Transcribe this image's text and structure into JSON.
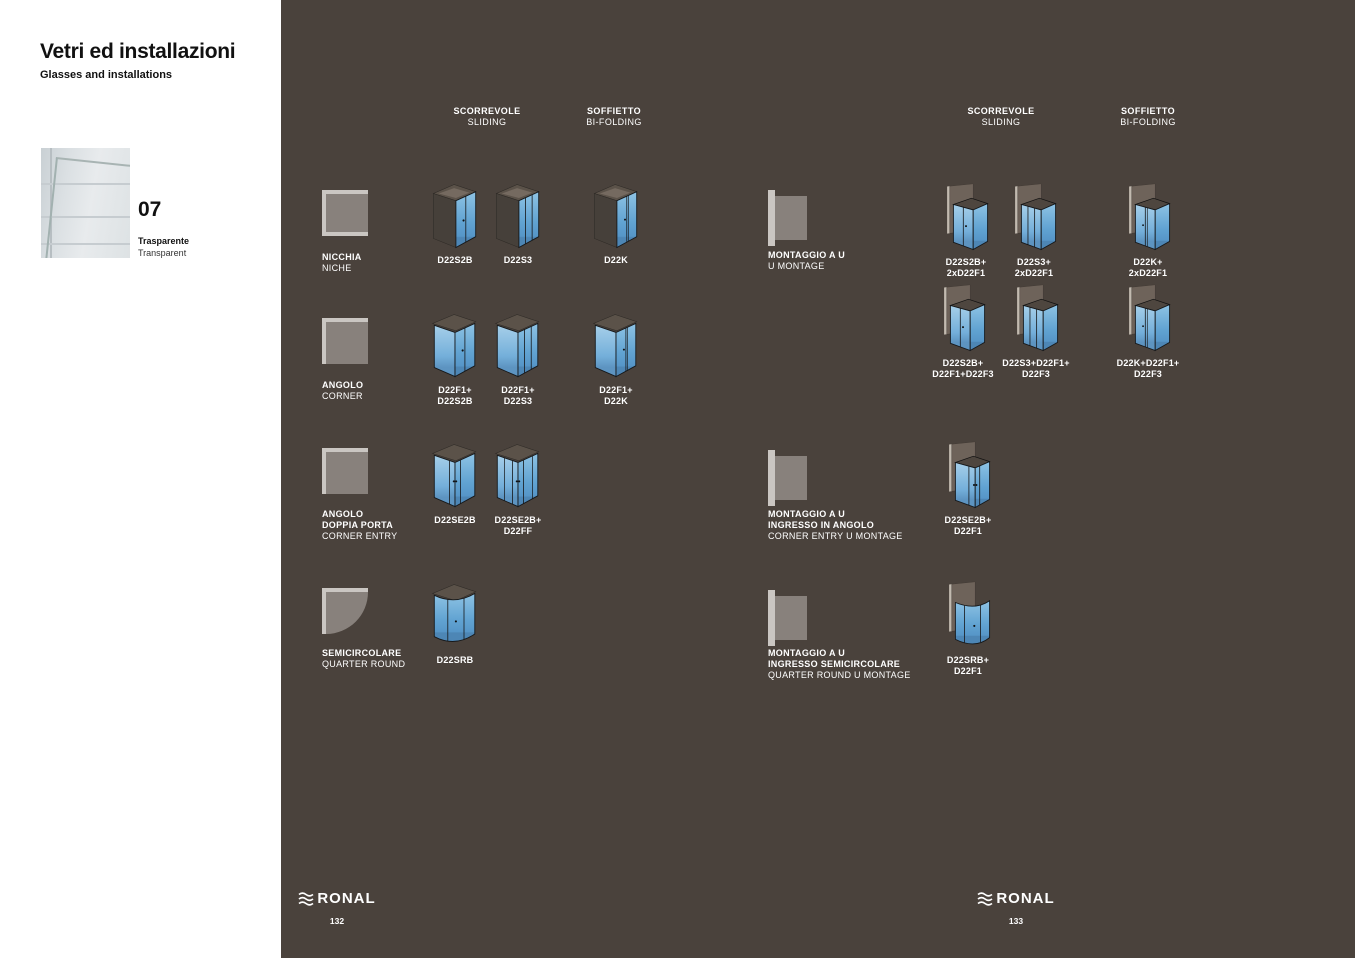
{
  "sidebar": {
    "title": "Vetri ed installazioni",
    "subtitle": "Glasses and installations",
    "swatch": {
      "number": "07",
      "name_primary": "Trasparente",
      "name_secondary": "Transparent",
      "image": "transparent-glass-photo"
    }
  },
  "colors": {
    "panel_bg": "#4a423c",
    "glass_blue": "#5f9fd2",
    "plan_icon_frame": "#cac6c2",
    "plan_icon_fill": "#88817c",
    "text": "#ffffff"
  },
  "groups": {
    "left": {
      "headers": [
        {
          "it": "SCORREVOLE",
          "en": "SLIDING"
        },
        {
          "it": "SOFFIETTO",
          "en": "BI-FOLDING"
        }
      ],
      "rows": [
        {
          "icon": "niche-plan-icon",
          "it1": "NICCHIA",
          "en": "NICHE",
          "products": [
            {
              "icon": "shower-sliding2-icon",
              "l1": "D22S2B"
            },
            {
              "icon": "shower-sliding3-icon",
              "l1": "D22S3"
            },
            {
              "icon": "shower-bifold-icon",
              "l1": "D22K"
            }
          ]
        },
        {
          "icon": "corner-plan-icon",
          "it1": "ANGOLO",
          "en": "CORNER",
          "products": [
            {
              "icon": "shower-corner-sliding2-icon",
              "l1": "D22F1+",
              "l2": "D22S2B"
            },
            {
              "icon": "shower-corner-sliding3-icon",
              "l1": "D22F1+",
              "l2": "D22S3"
            },
            {
              "icon": "shower-corner-bifold-icon",
              "l1": "D22F1+",
              "l2": "D22K"
            }
          ]
        },
        {
          "icon": "corner-entry-plan-icon",
          "it1": "ANGOLO",
          "it2": "DOPPIA PORTA",
          "en": "CORNER ENTRY",
          "products": [
            {
              "icon": "shower-corner-entry-icon",
              "l1": "D22SE2B"
            },
            {
              "icon": "shower-corner-entry-fixed-icon",
              "l1": "D22SE2B+",
              "l2": "D22FF"
            }
          ]
        },
        {
          "icon": "quarter-round-plan-icon",
          "it1": "SEMICIRCOLARE",
          "en": "QUARTER ROUND",
          "products": [
            {
              "icon": "shower-quarter-round-icon",
              "l1": "D22SRB"
            }
          ]
        }
      ]
    },
    "right": {
      "headers": [
        {
          "it": "SCORREVOLE",
          "en": "SLIDING"
        },
        {
          "it": "SOFFIETTO",
          "en": "BI-FOLDING"
        }
      ],
      "rows": [
        {
          "icon": "u-mount-plan-icon",
          "it1": "MONTAGGIO A U",
          "en": "U MONTAGE",
          "products": [
            {
              "icon": "shower-u-sliding2-icon",
              "l1": "D22S2B+",
              "l2": "2xD22F1"
            },
            {
              "icon": "shower-u-sliding3-icon",
              "l1": "D22S3+",
              "l2": "2xD22F1"
            },
            {
              "icon": "shower-u-bifold-icon",
              "l1": "D22K+",
              "l2": "2xD22F1"
            }
          ]
        },
        {
          "products": [
            {
              "icon": "shower-u-sliding2-fixed-icon",
              "l1": "D22S2B+",
              "l2": "D22F1+D22F3"
            },
            {
              "icon": "shower-u-sliding3-fixed-icon",
              "l1": "D22S3+D22F1+",
              "l2": "D22F3"
            },
            {
              "icon": "shower-u-bifold-fixed-icon",
              "l1": "D22K+D22F1+",
              "l2": "D22F3"
            }
          ]
        },
        {
          "icon": "u-mount-plan-icon",
          "it1": "MONTAGGIO A U",
          "it2": "INGRESSO IN ANGOLO",
          "en": "CORNER ENTRY U MONTAGE",
          "products": [
            {
              "icon": "shower-u-corner-entry-icon",
              "l1": "D22SE2B+",
              "l2": "D22F1"
            }
          ]
        },
        {
          "icon": "u-mount-plan-icon",
          "it1": "MONTAGGIO A U",
          "it2": "INGRESSO SEMICIRCOLARE",
          "en": "QUARTER ROUND U MONTAGE",
          "products": [
            {
              "icon": "shower-u-quarter-round-icon",
              "l1": "D22SRB+",
              "l2": "D22F1"
            }
          ]
        }
      ]
    }
  },
  "footer": {
    "left": {
      "brand": "RONAL",
      "page": "132",
      "logo_icon": "ronal-waves-icon"
    },
    "right": {
      "brand": "RONAL",
      "page": "133",
      "logo_icon": "ronal-waves-icon"
    }
  }
}
